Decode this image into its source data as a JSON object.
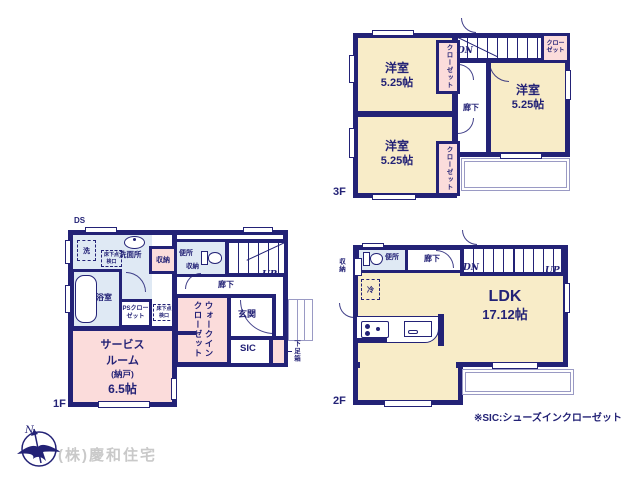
{
  "note": "※SIC:シューズインクローゼット",
  "company": "(株)慶和住宅",
  "compass": {
    "north": "N"
  },
  "f3": {
    "label": "3F",
    "room_nw_name": "洋室",
    "room_nw_size": "5.25帖",
    "room_sw_name": "洋室",
    "room_sw_size": "5.25帖",
    "room_e_name": "洋室",
    "room_e_size": "5.25帖",
    "closet_nw": "クローゼット",
    "closet_sw": "クローゼット",
    "closet_ne": "クローゼット",
    "hallway": "廊下",
    "dn": "DN"
  },
  "f2": {
    "label": "2F",
    "ldk_name": "LDK",
    "ldk_size": "17.12帖",
    "toilet": "便所",
    "hallway": "廊下",
    "storage": "収納",
    "fridge": "冷",
    "dn": "DN",
    "up": "UP"
  },
  "f1": {
    "label": "1F",
    "ds": "DS",
    "washer": "洗",
    "hatch": "床下点検口",
    "washroom": "洗面所",
    "storage_hall": "収納",
    "toilet": "便所",
    "toilet_storage": "収納",
    "bath": "浴室",
    "ps_closet": "PSクローゼット",
    "hallway": "廊下",
    "up": "UP",
    "hatch2": "床下点検口",
    "wic": "ウォークインクローゼット",
    "entrance": "玄関",
    "sic": "SIC",
    "shoebox": "下足箱",
    "service_line1": "サービス",
    "service_line2": "ルーム",
    "service_line3": "(納戸)",
    "service_size": "6.5帖"
  }
}
